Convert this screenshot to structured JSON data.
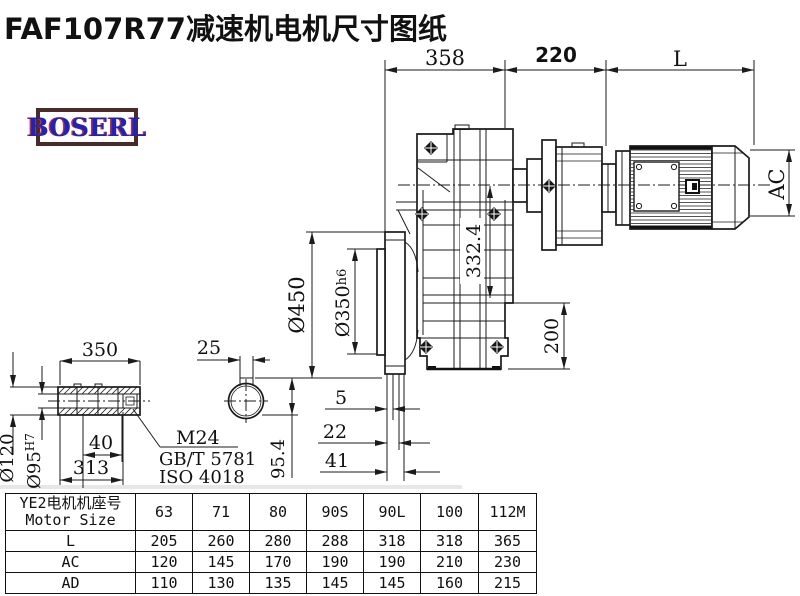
{
  "title": "FAF107R77减速机电机尺寸图纸",
  "logo": {
    "text": "BOSERL",
    "text_color": "#2222b8",
    "border_color": "#4a2b28"
  },
  "drawing": {
    "dims": {
      "top_width": "358",
      "top_mid": "220",
      "top_right": "L",
      "motor_diameter": "AC",
      "axis_distance": "332.4",
      "flange_od": "Ø450",
      "spigot": "Ø350",
      "spigot_tol": "h6",
      "bottom_height": "200",
      "offset_a": "5",
      "offset_b": "22",
      "offset_c": "41",
      "shaft_length": "350",
      "shaft_end": "25",
      "hub_od": "Ø120",
      "bore": "Ø95",
      "bore_tol": "H7",
      "bore_step": "40",
      "hub_length": "313",
      "key_height": "95.4"
    },
    "notes": {
      "thread": "M24",
      "standard_gb": "GB/T 5781",
      "standard_iso": "ISO 4018"
    }
  },
  "table": {
    "header_cn": "YE2电机机座号",
    "header_en": "Motor Size",
    "columns": [
      "63",
      "71",
      "80",
      "90S",
      "90L",
      "100",
      "112M"
    ],
    "rows": [
      {
        "label": "L",
        "cells": [
          "205",
          "260",
          "280",
          "288",
          "318",
          "318",
          "365"
        ]
      },
      {
        "label": "AC",
        "cells": [
          "120",
          "145",
          "170",
          "190",
          "190",
          "210",
          "230"
        ]
      },
      {
        "label": "AD",
        "cells": [
          "110",
          "130",
          "135",
          "145",
          "145",
          "160",
          "215"
        ]
      }
    ]
  }
}
